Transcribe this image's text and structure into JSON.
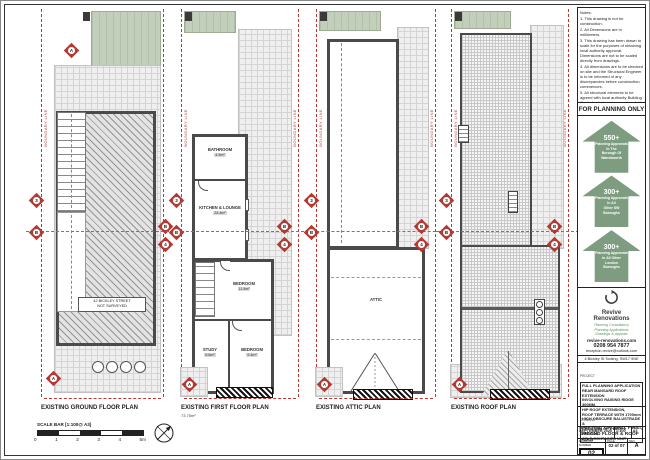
{
  "colors": {
    "accent_red": "#b23a32",
    "arrow_green": "#7e9d80",
    "garden_green": "#c2cfba",
    "wall_grey": "#4a4a4a"
  },
  "labels": {
    "boundary": "BOUNDARY LINE"
  },
  "markers": {
    "a": "A",
    "b": "B",
    "n3": "3",
    "n4": "4"
  },
  "scalebar": {
    "label": "SCALE BAR [1:100@ A3]",
    "ticks": [
      "0",
      "1",
      "2",
      "3",
      "4",
      "5m"
    ]
  },
  "plans": {
    "ground": {
      "title": "EXISTING GROUND FLOOR PLAN",
      "neighbour_line1": "42 BICKLEY STREET",
      "neighbour_line2": "NOT SURVEYED"
    },
    "first": {
      "title": "EXISTING FIRST FLOOR PLAN",
      "area": "73.75m²",
      "rooms": {
        "bathroom": {
          "name": "BATHROOM",
          "area": "4.5m²"
        },
        "kitchen": {
          "name": "KITCHEN & LOUNGE",
          "area": "24.4m²"
        },
        "bedroom1": {
          "name": "BEDROOM",
          "area": "11.9m²"
        },
        "study": {
          "name": "STUDY",
          "area": "5.6m²"
        },
        "bedroom2": {
          "name": "BEDROOM",
          "area": "9.4m²"
        }
      }
    },
    "attic": {
      "title": "EXISTING ATTIC PLAN",
      "room": "ATTIC"
    },
    "roof": {
      "title": "EXISTING ROOF PLAN"
    }
  },
  "titleblock": {
    "notes": [
      "Notes:",
      "1. This drawing is not for construction.",
      "2. All Dimensions are in millimeters.",
      "3. This drawing has been drawn to scale for the purposes of obtaining local authority approval. Dimensions are not to be scaled directly from drawings.",
      "4. All dimensions are to be checked on site and the Structural Engineer is to be informed of any discrepancies before construction commences.",
      "5. All structural elements to be agreed with local authority Building Control prior to commencement of works.",
      "6. All references to drawings refer to current revision of that drawing.",
      "7. The copyright of this drawing belongs to Revive Renovations & Licencing.",
      "8. Attention is drawn to the provisions of the party wall act 1996. Legal boundaries should be determined by others."
    ],
    "planning_only": "FOR PLANNING ONLY",
    "arrows": [
      {
        "count": "550+",
        "lines": [
          "Planning Approvals",
          "In The",
          "Borough Of",
          "Wandsworth"
        ]
      },
      {
        "count": "300+",
        "lines": [
          "Planning Approvals",
          "In All",
          "Other SW",
          "Boroughs"
        ]
      },
      {
        "count": "300+",
        "lines": [
          "Planning Approvals",
          "In All Other",
          "London",
          "Boroughs"
        ]
      }
    ],
    "company": {
      "name_line1": "Revive",
      "name_line2": "Renovations",
      "services": [
        "Planning Consultancy",
        "Planning Applications",
        "Drawings & Appeals"
      ],
      "website": "revive-renovations.com",
      "phone": "0208 954 7877",
      "email": "reception.revive@outlook.com",
      "address": "4 Bickley St Tooting, SW17 9NE"
    },
    "project": {
      "label": "PROJECT",
      "lines": [
        "FULL PLANNING APPLICATION",
        "REAR MANSARD ROOF EXTENSION",
        "INVOLVING RAISING RIDGE 300MM,",
        "HIP ROOF EXTENSION,",
        "ROOF TERRACE WITH 1700mm",
        "HIGH OBSCURE BALUSTRADE &",
        "CREATION OF 1 BED/ 1 PERSON",
        "SELF-CONTAINED UNIT"
      ]
    },
    "drawing": {
      "label": "DRAWING",
      "line1": "EXISTING GROUND, FIRST,",
      "line2": "SECOND FLOOR & ROOF PLAN"
    },
    "meta": {
      "date_label": "DATE",
      "date": "SEPTEMBER 2020",
      "scale_label": "SCALE",
      "scale": "1:100",
      "size_label": "SIZE",
      "size": "A3"
    },
    "number": {
      "label": "DRAWING NUMBER",
      "value": "02",
      "page_label": "PAGE",
      "page": "02 of 07",
      "rev_label": "REV",
      "rev": "A"
    }
  }
}
